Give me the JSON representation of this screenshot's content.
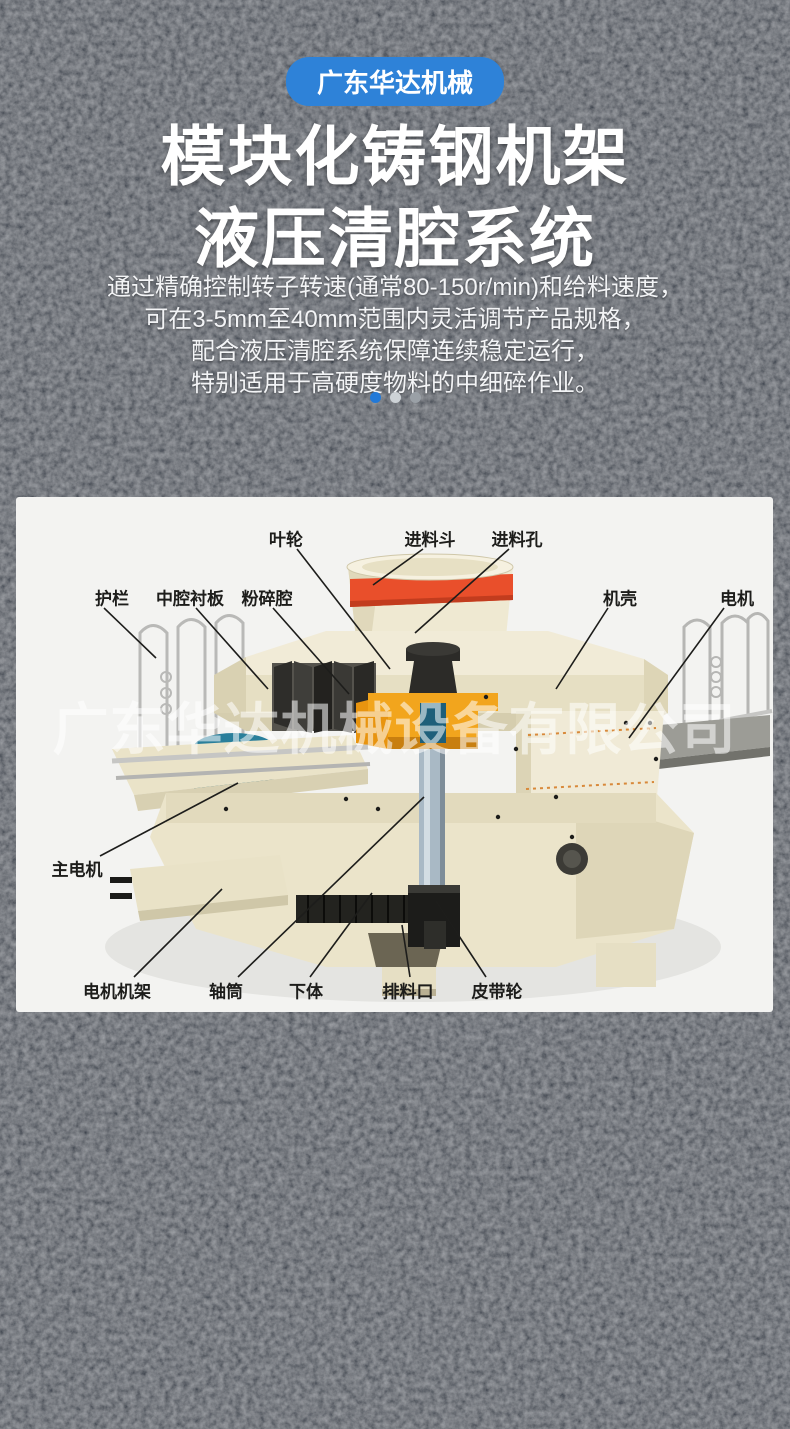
{
  "badge": {
    "label": "广东华达机械"
  },
  "title": {
    "line1": "模块化铸钢机架",
    "line2": "液压清腔系统"
  },
  "description": {
    "line1": "通过精确控制转子转速(通常80-150r/min)和给料速度，",
    "line2": "可在3-5mm至40mm范围内灵活调节产品规格，",
    "line3": "配合液压清腔系统保障连续稳定运行，",
    "line4": "特别适用于高硬度物料的中细碎作业。"
  },
  "carousel": {
    "dots": [
      {
        "color": "#2279d8",
        "active": true
      },
      {
        "color": "#cdd2d6",
        "active": false
      },
      {
        "color": "#9aa0a6",
        "active": false
      }
    ]
  },
  "watermark": {
    "text": "广东华达机械设备有限公司"
  },
  "diagram": {
    "type": "labeled-parts-diagram",
    "labels": [
      {
        "text": "叶轮",
        "x": 270,
        "y": 41,
        "line": [
          281,
          52,
          374,
          172
        ]
      },
      {
        "text": "进料斗",
        "x": 414,
        "y": 41,
        "line": [
          407,
          52,
          357,
          88
        ]
      },
      {
        "text": "进料孔",
        "x": 501,
        "y": 41,
        "line": [
          493,
          52,
          399,
          136
        ]
      },
      {
        "text": "护栏",
        "x": 96,
        "y": 100,
        "line": [
          88,
          111,
          140,
          161
        ]
      },
      {
        "text": "中腔衬板",
        "x": 174,
        "y": 100,
        "line": [
          180,
          111,
          252,
          192
        ]
      },
      {
        "text": "粉碎腔",
        "x": 251,
        "y": 100,
        "line": [
          257,
          111,
          333,
          197
        ]
      },
      {
        "text": "机壳",
        "x": 604,
        "y": 100,
        "line": [
          592,
          111,
          540,
          192
        ]
      },
      {
        "text": "电机",
        "x": 721,
        "y": 100,
        "line": [
          708,
          111,
          613,
          241
        ]
      },
      {
        "text": "主电机",
        "x": 61,
        "y": 371,
        "line": [
          84,
          359,
          222,
          286
        ]
      },
      {
        "text": "电机机架",
        "x": 101,
        "y": 493,
        "line": [
          118,
          480,
          206,
          392
        ]
      },
      {
        "text": "轴筒",
        "x": 210,
        "y": 493,
        "line": [
          222,
          480,
          408,
          300
        ]
      },
      {
        "text": "下体",
        "x": 290,
        "y": 493,
        "line": [
          294,
          480,
          356,
          396
        ]
      },
      {
        "text": "排料口",
        "x": 392,
        "y": 493,
        "line": [
          394,
          480,
          386,
          428
        ]
      },
      {
        "text": "皮带轮",
        "x": 481,
        "y": 493,
        "line": [
          470,
          480,
          420,
          404
        ]
      }
    ]
  },
  "colors": {
    "accent_blue": "#2e82d8",
    "panel_bg": "#f3f3f1",
    "machine_cream": "#ece5cb",
    "band_red": "#e94f2b",
    "impeller_yellow": "#f2a51d",
    "motor_teal": "#1d6a82",
    "label_ink": "#1d1d1b"
  }
}
